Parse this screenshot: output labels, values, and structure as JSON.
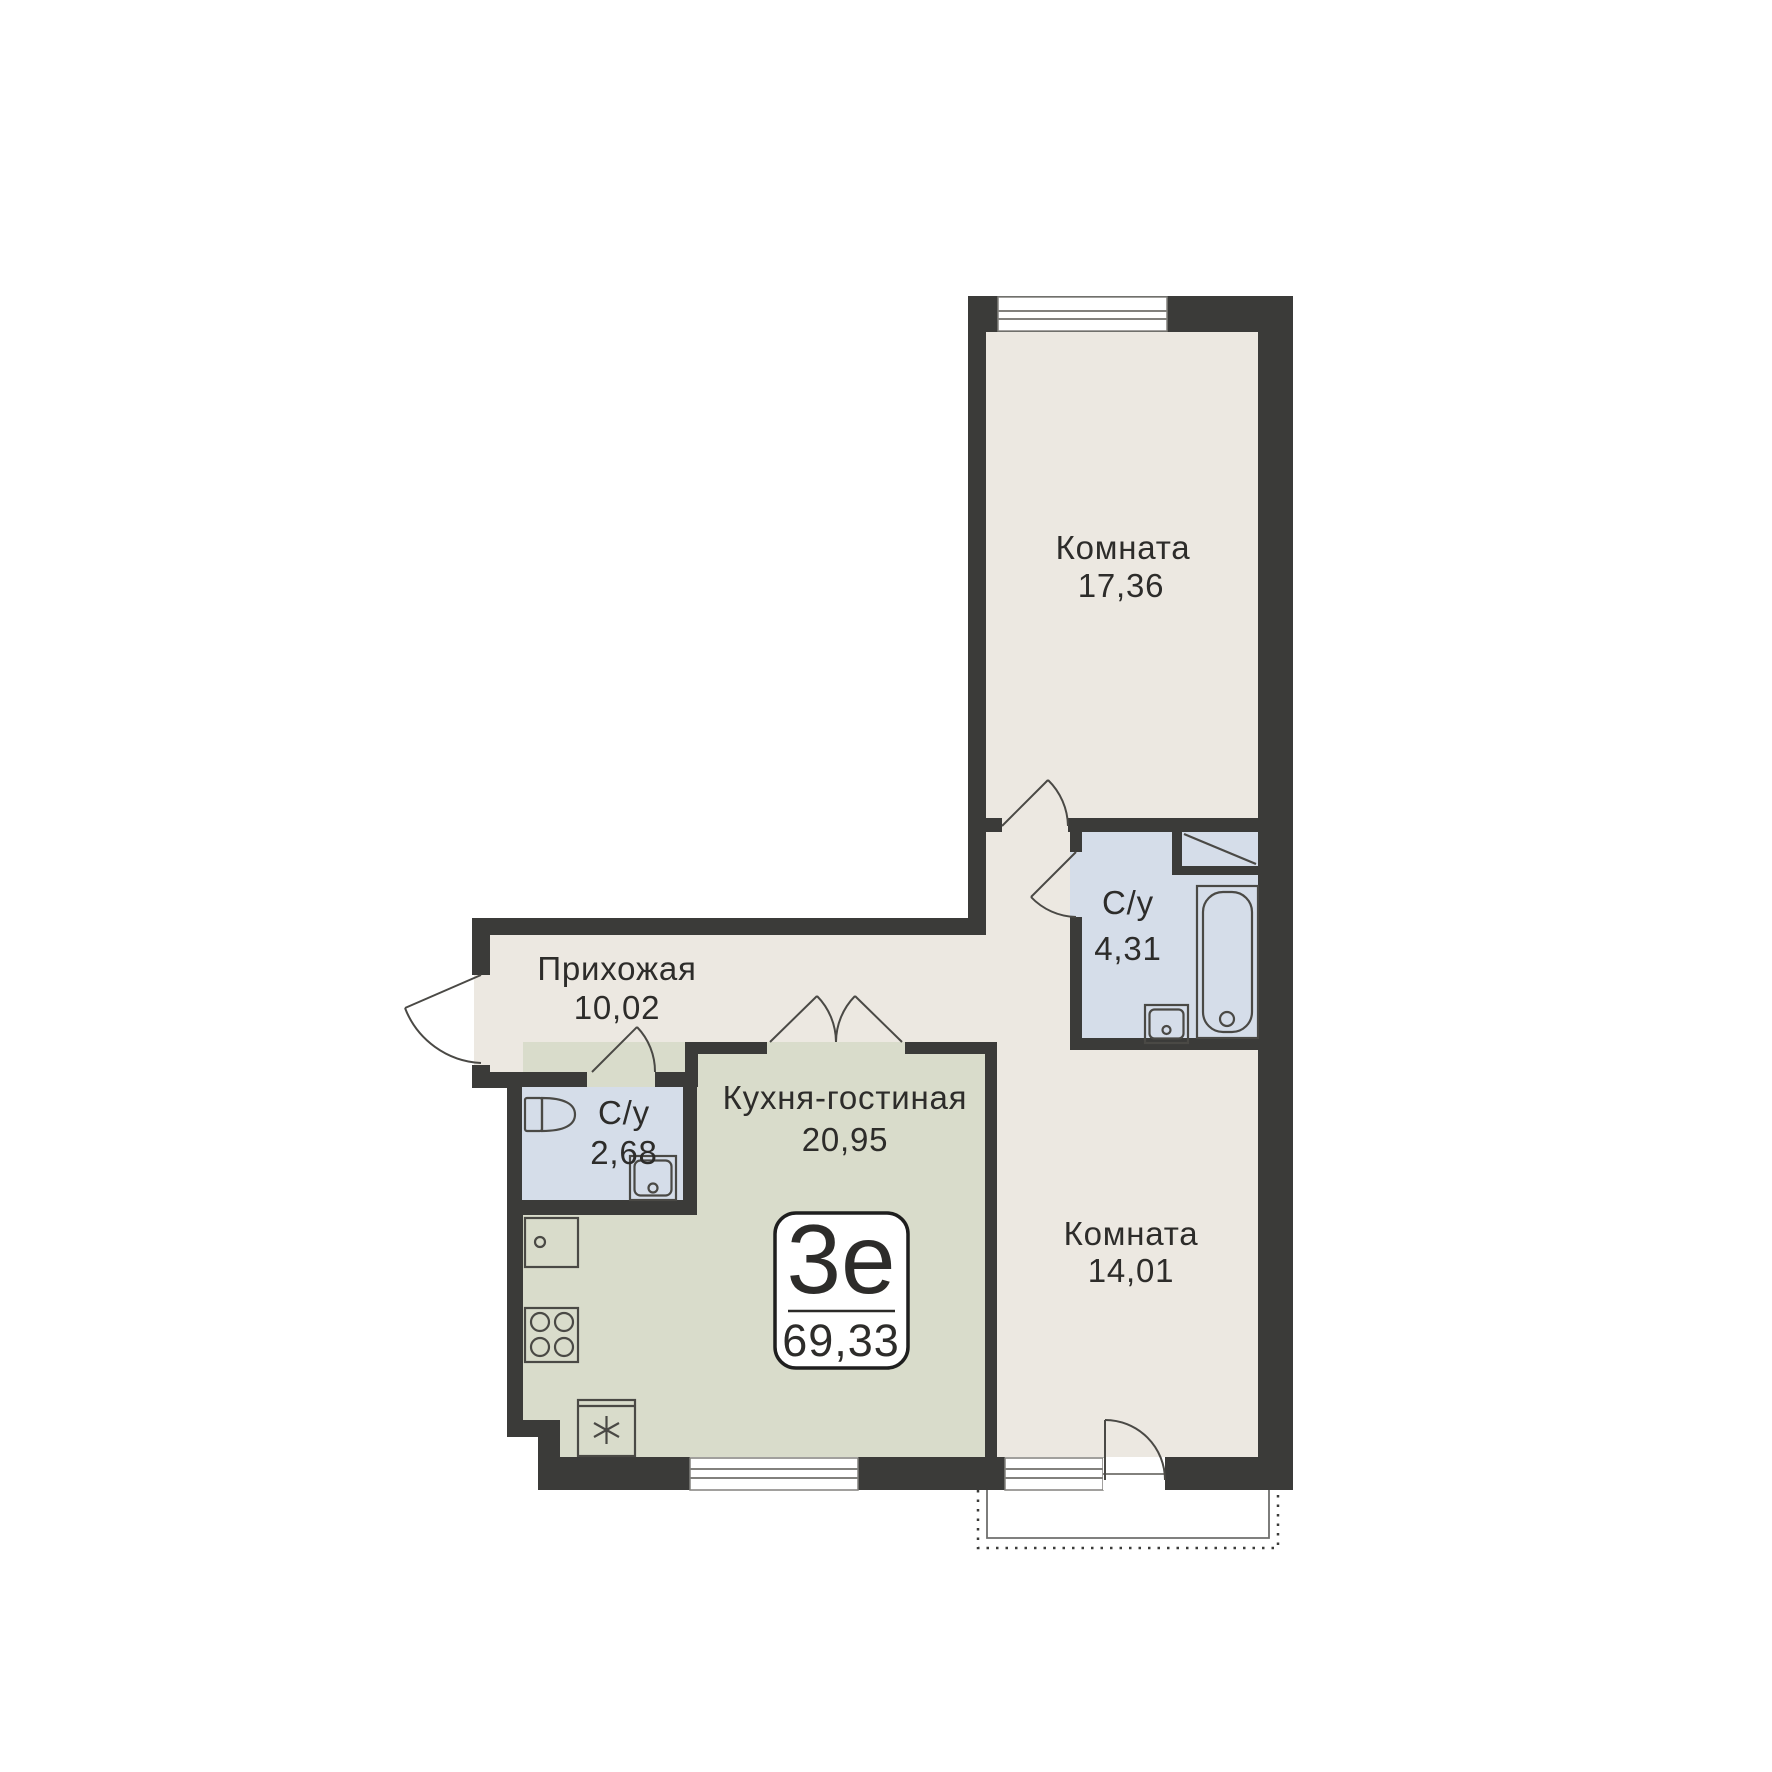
{
  "plan": {
    "badge": {
      "apartment_type": "3е",
      "total_area": "69,33"
    },
    "rooms": [
      {
        "name": "Комната",
        "area": "17,36",
        "fixtures": [
          "window-icon",
          "door-arc-icon"
        ]
      },
      {
        "name": "С/у",
        "area": "4,31",
        "fixtures": [
          "bathtub-icon",
          "sink-icon",
          "shaft-diagonal-icon",
          "door-arc-icon"
        ]
      },
      {
        "name": "Прихожая",
        "area": "10,02",
        "fixtures": [
          "entry-door-arc-icon"
        ]
      },
      {
        "name": "С/у",
        "area": "2,68",
        "fixtures": [
          "toilet-icon",
          "sink-icon",
          "door-arc-icon"
        ]
      },
      {
        "name": "Кухня-гостиная",
        "area": "20,95",
        "fixtures": [
          "kitchen-sink-icon",
          "stove-icon",
          "fridge-icon",
          "double-door-arc-icon",
          "window-icon"
        ]
      },
      {
        "name": "Комната",
        "area": "14,01",
        "fixtures": [
          "window-icon",
          "balcony-door-arc-icon",
          "balcony-icon"
        ]
      }
    ],
    "colors": {
      "wall": "#3B3B39",
      "floor_beige": "#ECE8E1",
      "floor_green": "#D9DCCB",
      "floor_blue": "#D5DDE9",
      "badge_border": "#1E1E1E",
      "text": "#2D2C2A"
    }
  }
}
